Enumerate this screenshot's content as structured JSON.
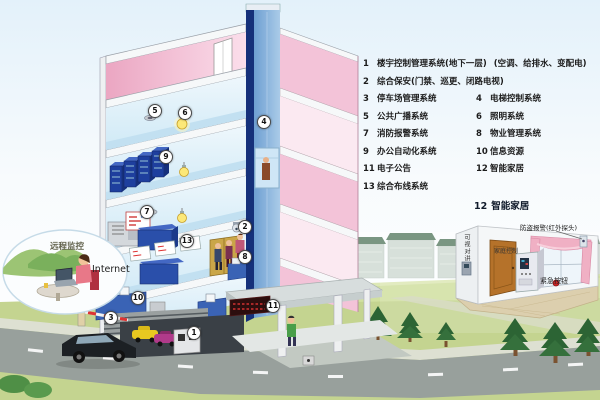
{
  "legend": {
    "items": [
      {
        "num": "1",
        "label": "楼宇控制管理系统(地下一层)",
        "note": "(空调、给排水、变配电)"
      },
      {
        "num": "2",
        "label": "综合保安(门禁、巡更、闭路电视)"
      },
      {
        "num": "3",
        "label": "停车场管理系统"
      },
      {
        "num": "4",
        "label": "电梯控制系统"
      },
      {
        "num": "5",
        "label": "公共广播系统"
      },
      {
        "num": "6",
        "label": "照明系统"
      },
      {
        "num": "7",
        "label": "消防报警系统"
      },
      {
        "num": "8",
        "label": "物业管理系统"
      },
      {
        "num": "9",
        "label": "办公自动化系统"
      },
      {
        "num": "10",
        "label": "信息资源"
      },
      {
        "num": "11",
        "label": "电子公告"
      },
      {
        "num": "12",
        "label": "智能家居"
      },
      {
        "num": "13",
        "label": "综合布线系统"
      }
    ]
  },
  "cloud": {
    "title": "远程监控",
    "internet": "Internet"
  },
  "smart_home": {
    "title_num": "12",
    "title": "智能家居",
    "alarm_label": "防盗报警(红外探头)",
    "intercom_label": "可视对讲",
    "controller_label": "家庭控制",
    "emergency_label": "紧急按钮"
  },
  "markers": {
    "m1": "1",
    "m2": "2",
    "m3": "3",
    "m4": "4",
    "m5": "5",
    "m6": "6",
    "m7": "7",
    "m8": "8",
    "m9": "9",
    "m10": "10",
    "m11": "11",
    "m13": "13"
  },
  "colors": {
    "building_wall_pink": "#f2b8cc",
    "interior_blue": "#cfe9f6",
    "elevator_shaft_blue": "#6e9fd2",
    "server_rack_blue": "#1e3f9e",
    "lawn_green": "#c4d490",
    "led_sign_red": "#cc2222",
    "curtain_pink": "#f0b0c4",
    "door_wood": "#b5722a"
  }
}
